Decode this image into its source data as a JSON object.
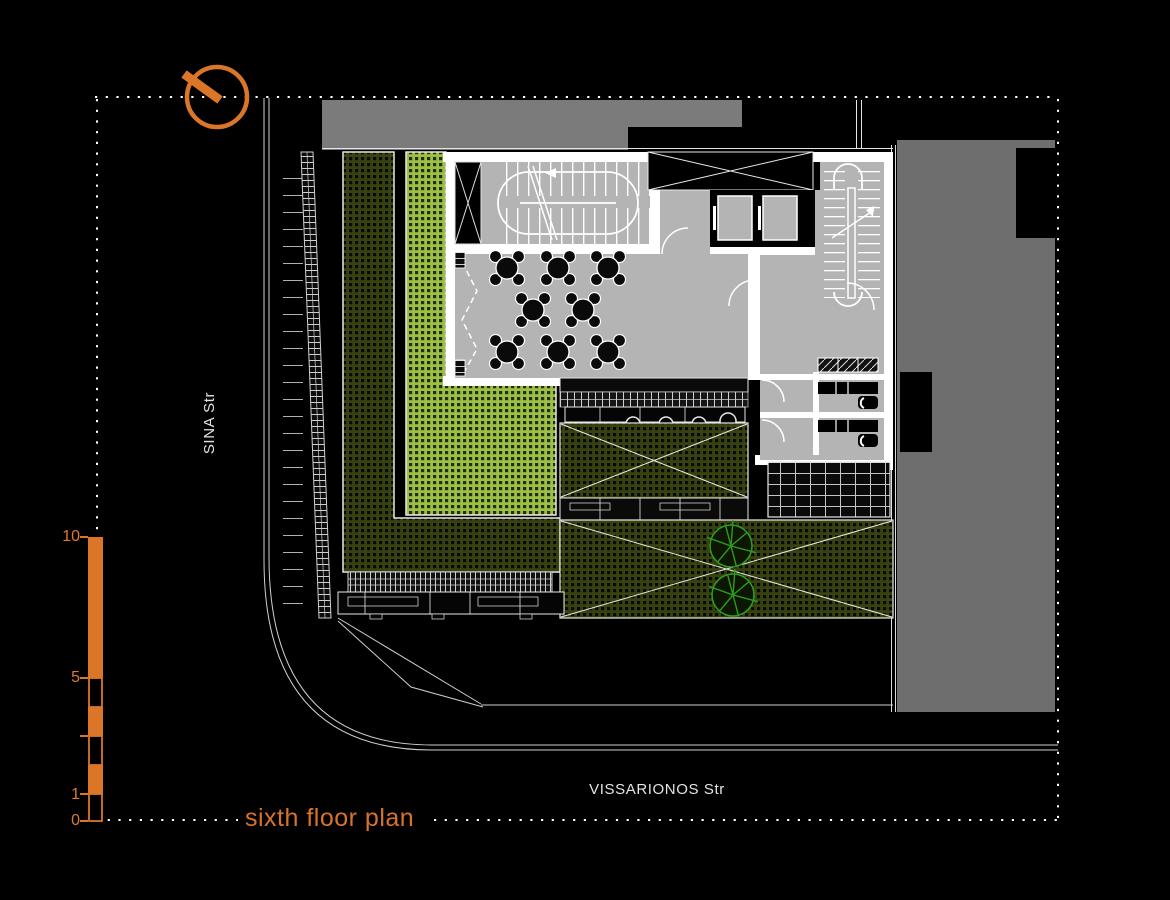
{
  "meta": {
    "drawing_type": "architectural floor plan on black background"
  },
  "title": {
    "label": "sixth floor plan"
  },
  "streets": {
    "left_vertical": "SINA Str",
    "bottom_horizontal": "VISSARIONOS Str"
  },
  "scale_bar": {
    "label_10": "10",
    "label_5": "5",
    "label_1": "1",
    "label_0": "0"
  },
  "icons": {
    "north_arrow": "north-arrow-icon",
    "tree": "tree-icon"
  },
  "colors": {
    "background": "#000000",
    "accent_orange": "#DB7628",
    "floor_gray": "#B4B4B4",
    "adjacent_building_gray": "#6E6E6E",
    "adjacent_building_top_gray": "#7B7B7B",
    "terrace_bright_green": "#9CC043",
    "terrace_dark_green": "#37420E",
    "tree_green": "#2F9B1F",
    "line_white": "#E8E8E8"
  }
}
